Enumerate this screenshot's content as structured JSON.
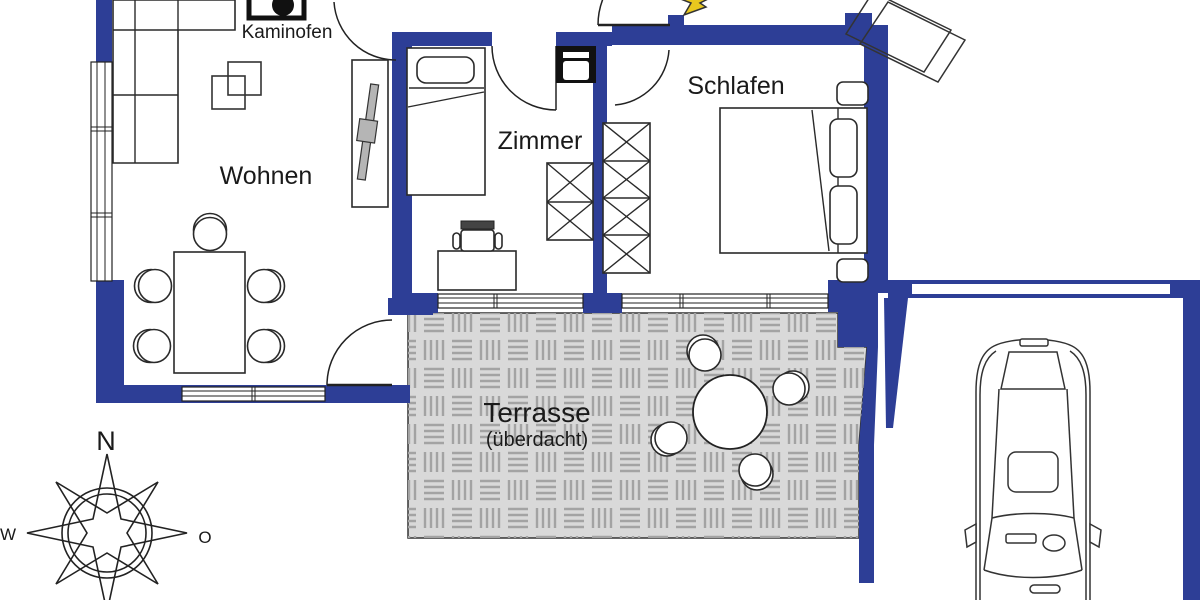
{
  "rooms": {
    "living": "Wohnen",
    "room": "Zimmer",
    "bedroom": "Schlafen",
    "terrace": "Terrasse",
    "terrace_note": "(überdacht)",
    "stove": "Kaminofen"
  },
  "compass": {
    "north": "N",
    "west": "W",
    "east": "O"
  },
  "colors": {
    "wall": "#2d3e96",
    "terrace_fill": "#d9d9d9",
    "terrace_hatch": "#a3a3a3",
    "line": "#222222",
    "entrance_arrow": "#e8c81e"
  },
  "icons": {
    "stove_icon": "black square with filled circle",
    "appliance_icon": "black box with white door slot",
    "compass_rose_icon": "eight point star with two circles",
    "car_icon": "car top view",
    "entrance_arrow_icon": "yellow arrow"
  }
}
